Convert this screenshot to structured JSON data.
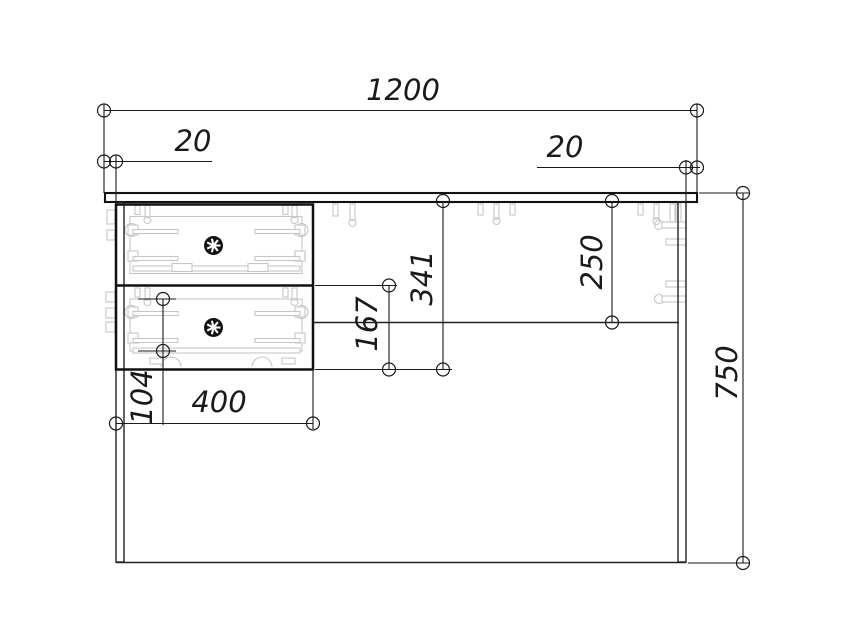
{
  "drawing": {
    "kind": "furniture-front-elevation-technical-drawing",
    "dimensions": {
      "total_width": "1200",
      "left_overhang": "20",
      "right_overhang": "20",
      "total_height": "750",
      "back_panel_height": "250",
      "drawer_unit_height": "341",
      "lower_drawer_height": "167",
      "drawer_box_side_height": "104",
      "drawer_unit_width": "400"
    },
    "colors": {
      "line": "#1a1a1a",
      "hardware_detail": "#c6c6c6",
      "background": "#ffffff"
    }
  }
}
